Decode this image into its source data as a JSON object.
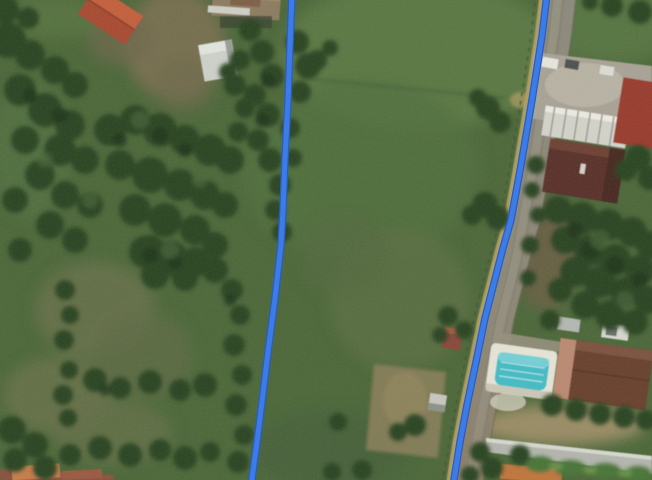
{
  "map": {
    "view_type": "satellite",
    "overlay": {
      "route_color": "#3d7ce6",
      "route_casing_color": "#2a5dc0",
      "route_width": "5",
      "route_casing_width": "7.5",
      "routes": [
        {
          "name": "route-line-west",
          "points": "292,-6 290,45 288,100 285,158 283,210 281,245 275,298 268,352 262,402 257,442 251,486"
        },
        {
          "name": "route-line-east",
          "points": "547,-6 542,36 532,100 521,165 511,220 503,248 494,283 485,318 476,362 467,405 460,442 453,486"
        }
      ]
    },
    "features": {
      "pasture_color": "#54713f",
      "tree_color": "#2b4524",
      "road_color": "#8d8a7b",
      "road_shoulder_color": "#b1a062",
      "pool_color": "#45bcc6",
      "red_roof_color": "#a84b33",
      "dark_roof_color": "#5a332a",
      "metal_roof_color": "#d3d3ca",
      "wall_color": "#b4b6ae"
    }
  }
}
